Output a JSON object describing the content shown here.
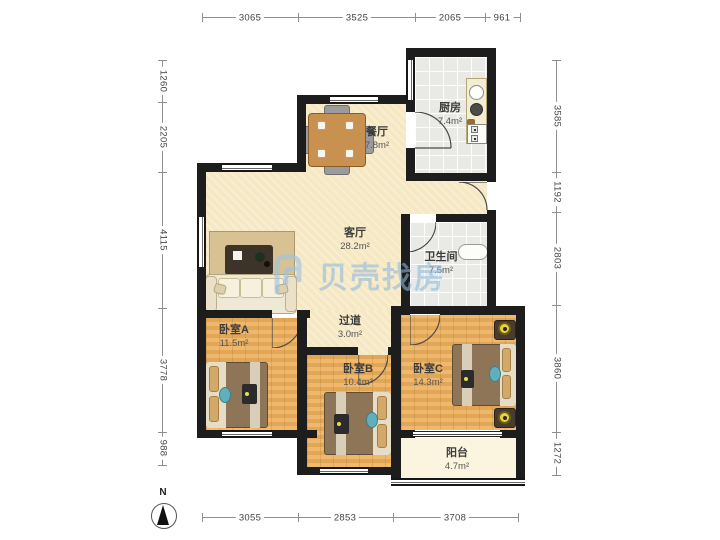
{
  "watermark": {
    "brand": "贝壳找房"
  },
  "compass": {
    "north": "N"
  },
  "rooms": {
    "dining": {
      "name": "餐厅",
      "area": "7.8m²"
    },
    "kitchen": {
      "name": "厨房",
      "area": "7.4m²"
    },
    "living": {
      "name": "客厅",
      "area": "28.2m²"
    },
    "bathroom": {
      "name": "卫生间",
      "area": "7.5m²"
    },
    "hallway": {
      "name": "过道",
      "area": "3.0m²"
    },
    "bedroomA": {
      "name": "卧室A",
      "area": "11.5m²"
    },
    "bedroomB": {
      "name": "卧室B",
      "area": "10.4m²"
    },
    "bedroomC": {
      "name": "卧室C",
      "area": "14.3m²"
    },
    "balcony": {
      "name": "阳台",
      "area": "4.7m²"
    }
  },
  "dimensions": {
    "top": [
      "3065",
      "3525",
      "2065",
      "961"
    ],
    "left": [
      "1260",
      "2205",
      "4115",
      "3778",
      "988"
    ],
    "right": [
      "3585",
      "1192",
      "2803",
      "3860",
      "1272"
    ],
    "bottom": [
      "3055",
      "2853",
      "3708"
    ]
  },
  "colors": {
    "wall": "#1d1d1d",
    "floor_beige": "#f6e8c2",
    "floor_wood": "#edb05c",
    "floor_tile": "#e9e9e5",
    "watermark_blue": "#8bb8de"
  }
}
